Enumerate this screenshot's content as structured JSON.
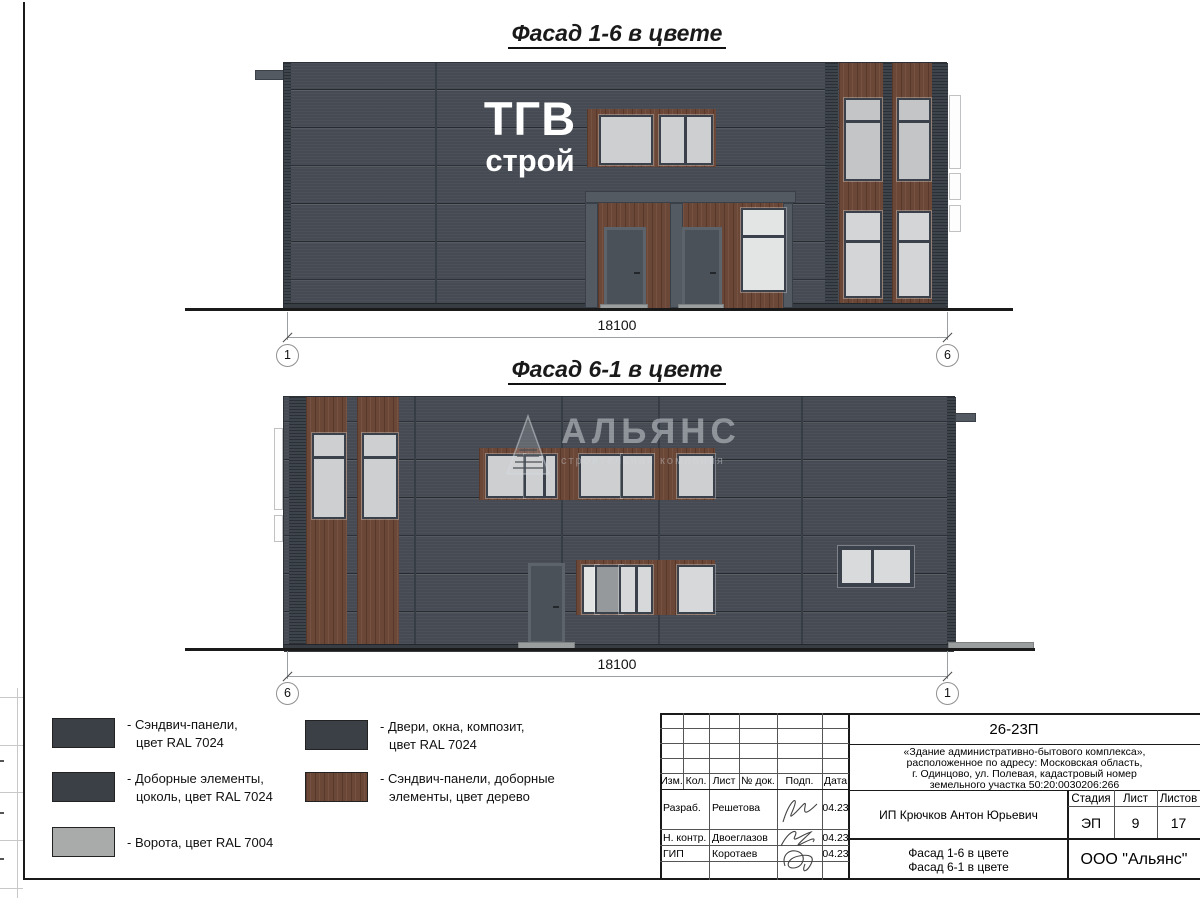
{
  "colors": {
    "wall": "#464b53",
    "wood": "#6b4737",
    "glass": "#cdcfd0",
    "gate_gray": "#a9abaa",
    "panel_dark": "#3b4047"
  },
  "facade1": {
    "title": "Фасад 1-6 в цвете",
    "dimension": "18100",
    "axis_left": "1",
    "axis_right": "6",
    "logo_line1": "ТГВ",
    "logo_line2": "строй"
  },
  "facade2": {
    "title": "Фасад 6-1 в цвете",
    "dimension": "18100",
    "axis_left": "6",
    "axis_right": "1",
    "watermark_name": "АЛЬЯНС",
    "watermark_sub": "строительная компания"
  },
  "legend": {
    "items": [
      {
        "line1": "- Сэндвич-панели,",
        "line2": "цвет RAL 7024"
      },
      {
        "line1": "- Доборные элементы,",
        "line2": "цоколь, цвет RAL 7024"
      },
      {
        "line1": "- Ворота, цвет RAL 7004",
        "line2": ""
      },
      {
        "line1": "- Двери, окна, композит,",
        "line2": "цвет RAL 7024"
      },
      {
        "line1": "- Сэндвич-панели, доборные",
        "line2": "элементы, цвет дерево"
      }
    ]
  },
  "titleblock": {
    "doc_number": "26-23П",
    "address": [
      "«Здание административно-бытового комплекса»,",
      "расположенное по адресу: Московская область,",
      "г. Одинцово, ул. Полевая, кадастровый номер",
      "земельного участка 50:20:0030206:266"
    ],
    "cols": {
      "izm": "Изм.",
      "kol": "Кол.",
      "list": "Лист",
      "ndok": "№ док.",
      "podp": "Подп.",
      "data": "Дата"
    },
    "rows": [
      {
        "role": "Разраб.",
        "name": "Решетова",
        "date": "04.23"
      },
      {
        "role": "Н. контр.",
        "name": "Двоеглазов",
        "date": "04.23"
      },
      {
        "role": "ГИП",
        "name": "Коротаев",
        "date": "04.23"
      }
    ],
    "client": "ИП Крючков Антон Юрьевич",
    "stage_label": "Стадия",
    "sheet_label": "Лист",
    "sheets_label": "Листов",
    "stage": "ЭП",
    "sheet": "9",
    "sheets": "17",
    "subject_line1": "Фасад 1-6 в цвете",
    "subject_line2": "Фасад 6-1 в цвете",
    "company": "ООО \"Альянс\""
  }
}
